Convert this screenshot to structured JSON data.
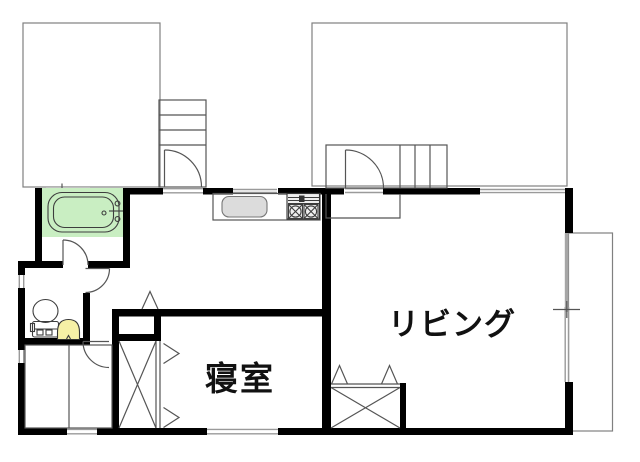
{
  "plan": {
    "type": "floor-plan",
    "rooms": {
      "living": {
        "label": "リビング"
      },
      "bedroom": {
        "label": "寝室"
      }
    },
    "fixtures": {
      "bathtub": "bathtub-icon",
      "toilet": "toilet-icon",
      "wash_basin": "wash-basin-icon",
      "kitchen_sink": "kitchen-sink-icon",
      "stove": "two-burner-stove-icon",
      "stairs_upper": "stairs-icon",
      "stairs_entry": "stairs-icon",
      "bedroom_closet": "closet-cross-icon",
      "living_closet": "closet-cross-icon",
      "balcony": "balcony-outline"
    },
    "colors": {
      "wall": "#000000",
      "bath_fill": "#c9eec2",
      "basin_fill": "#f6f0a6",
      "sink_fill": "#dcdcdc",
      "stove_fill": "#efefef",
      "line": "#555555",
      "upper_floor_line": "#808080",
      "background": "#ffffff"
    }
  }
}
